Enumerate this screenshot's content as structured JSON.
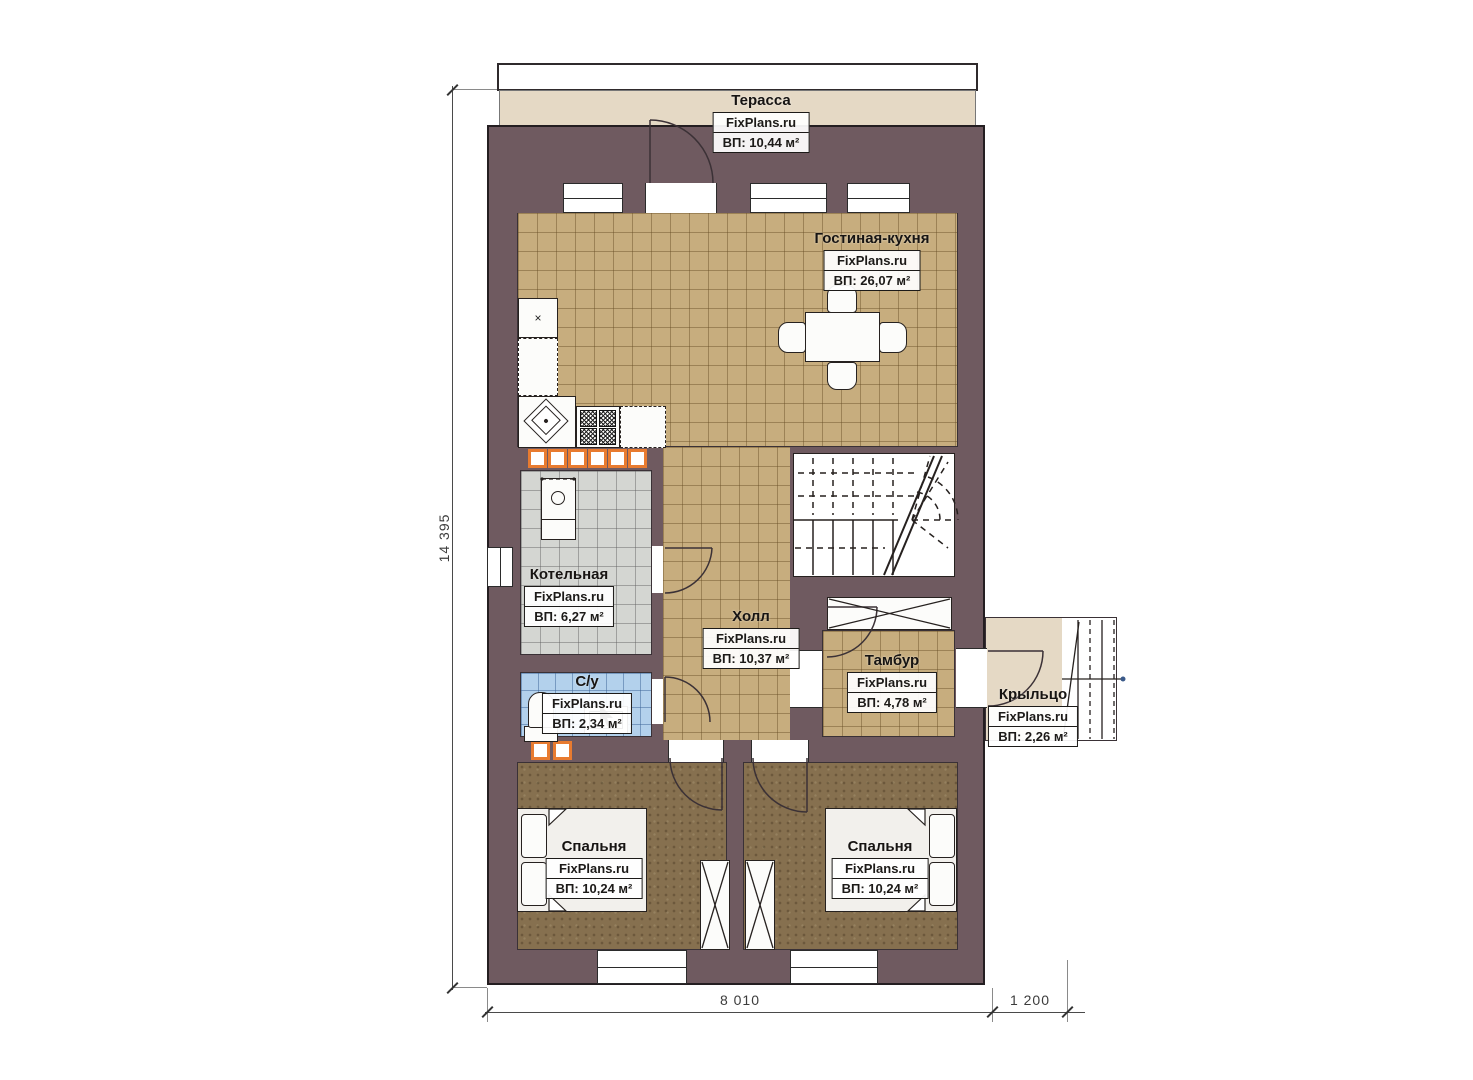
{
  "brand": "FixPlans.ru",
  "rooms": {
    "terrace": {
      "name": "Терасса",
      "site": "FixPlans.ru",
      "area": "ВП: 10,44 м²"
    },
    "living_kitchen": {
      "name": "Гостиная-кухня",
      "site": "FixPlans.ru",
      "area": "ВП: 26,07 м²"
    },
    "boiler": {
      "name": "Котельная",
      "site": "FixPlans.ru",
      "area": "ВП: 6,27 м²"
    },
    "hall": {
      "name": "Холл",
      "site": "FixPlans.ru",
      "area": "ВП: 10,37 м²"
    },
    "wc": {
      "name": "С/у",
      "site": "FixPlans.ru",
      "area": "ВП: 2,34 м²"
    },
    "vestibule": {
      "name": "Тамбур",
      "site": "FixPlans.ru",
      "area": "ВП: 4,78 м²"
    },
    "porch": {
      "name": "Крыльцо",
      "site": "FixPlans.ru",
      "area": "ВП: 2,26 м²"
    },
    "bedroom_left": {
      "name": "Спальня",
      "site": "FixPlans.ru",
      "area": "ВП: 10,24 м²"
    },
    "bedroom_right": {
      "name": "Спальня",
      "site": "FixPlans.ru",
      "area": "ВП: 10,24 м²"
    }
  },
  "dimensions": {
    "height_total": "14 395",
    "width_main": "8 010",
    "width_porch": "1 200"
  },
  "colors": {
    "wall": "#6f5a60",
    "tile_tan": "#c7ad7e",
    "tile_gray": "#d4d6d2",
    "tile_blue": "#b3d1ec",
    "floor_bedroom": "#86704f",
    "floor_terrace": "#e5d9c5",
    "accent_orange": "#e87b30"
  }
}
